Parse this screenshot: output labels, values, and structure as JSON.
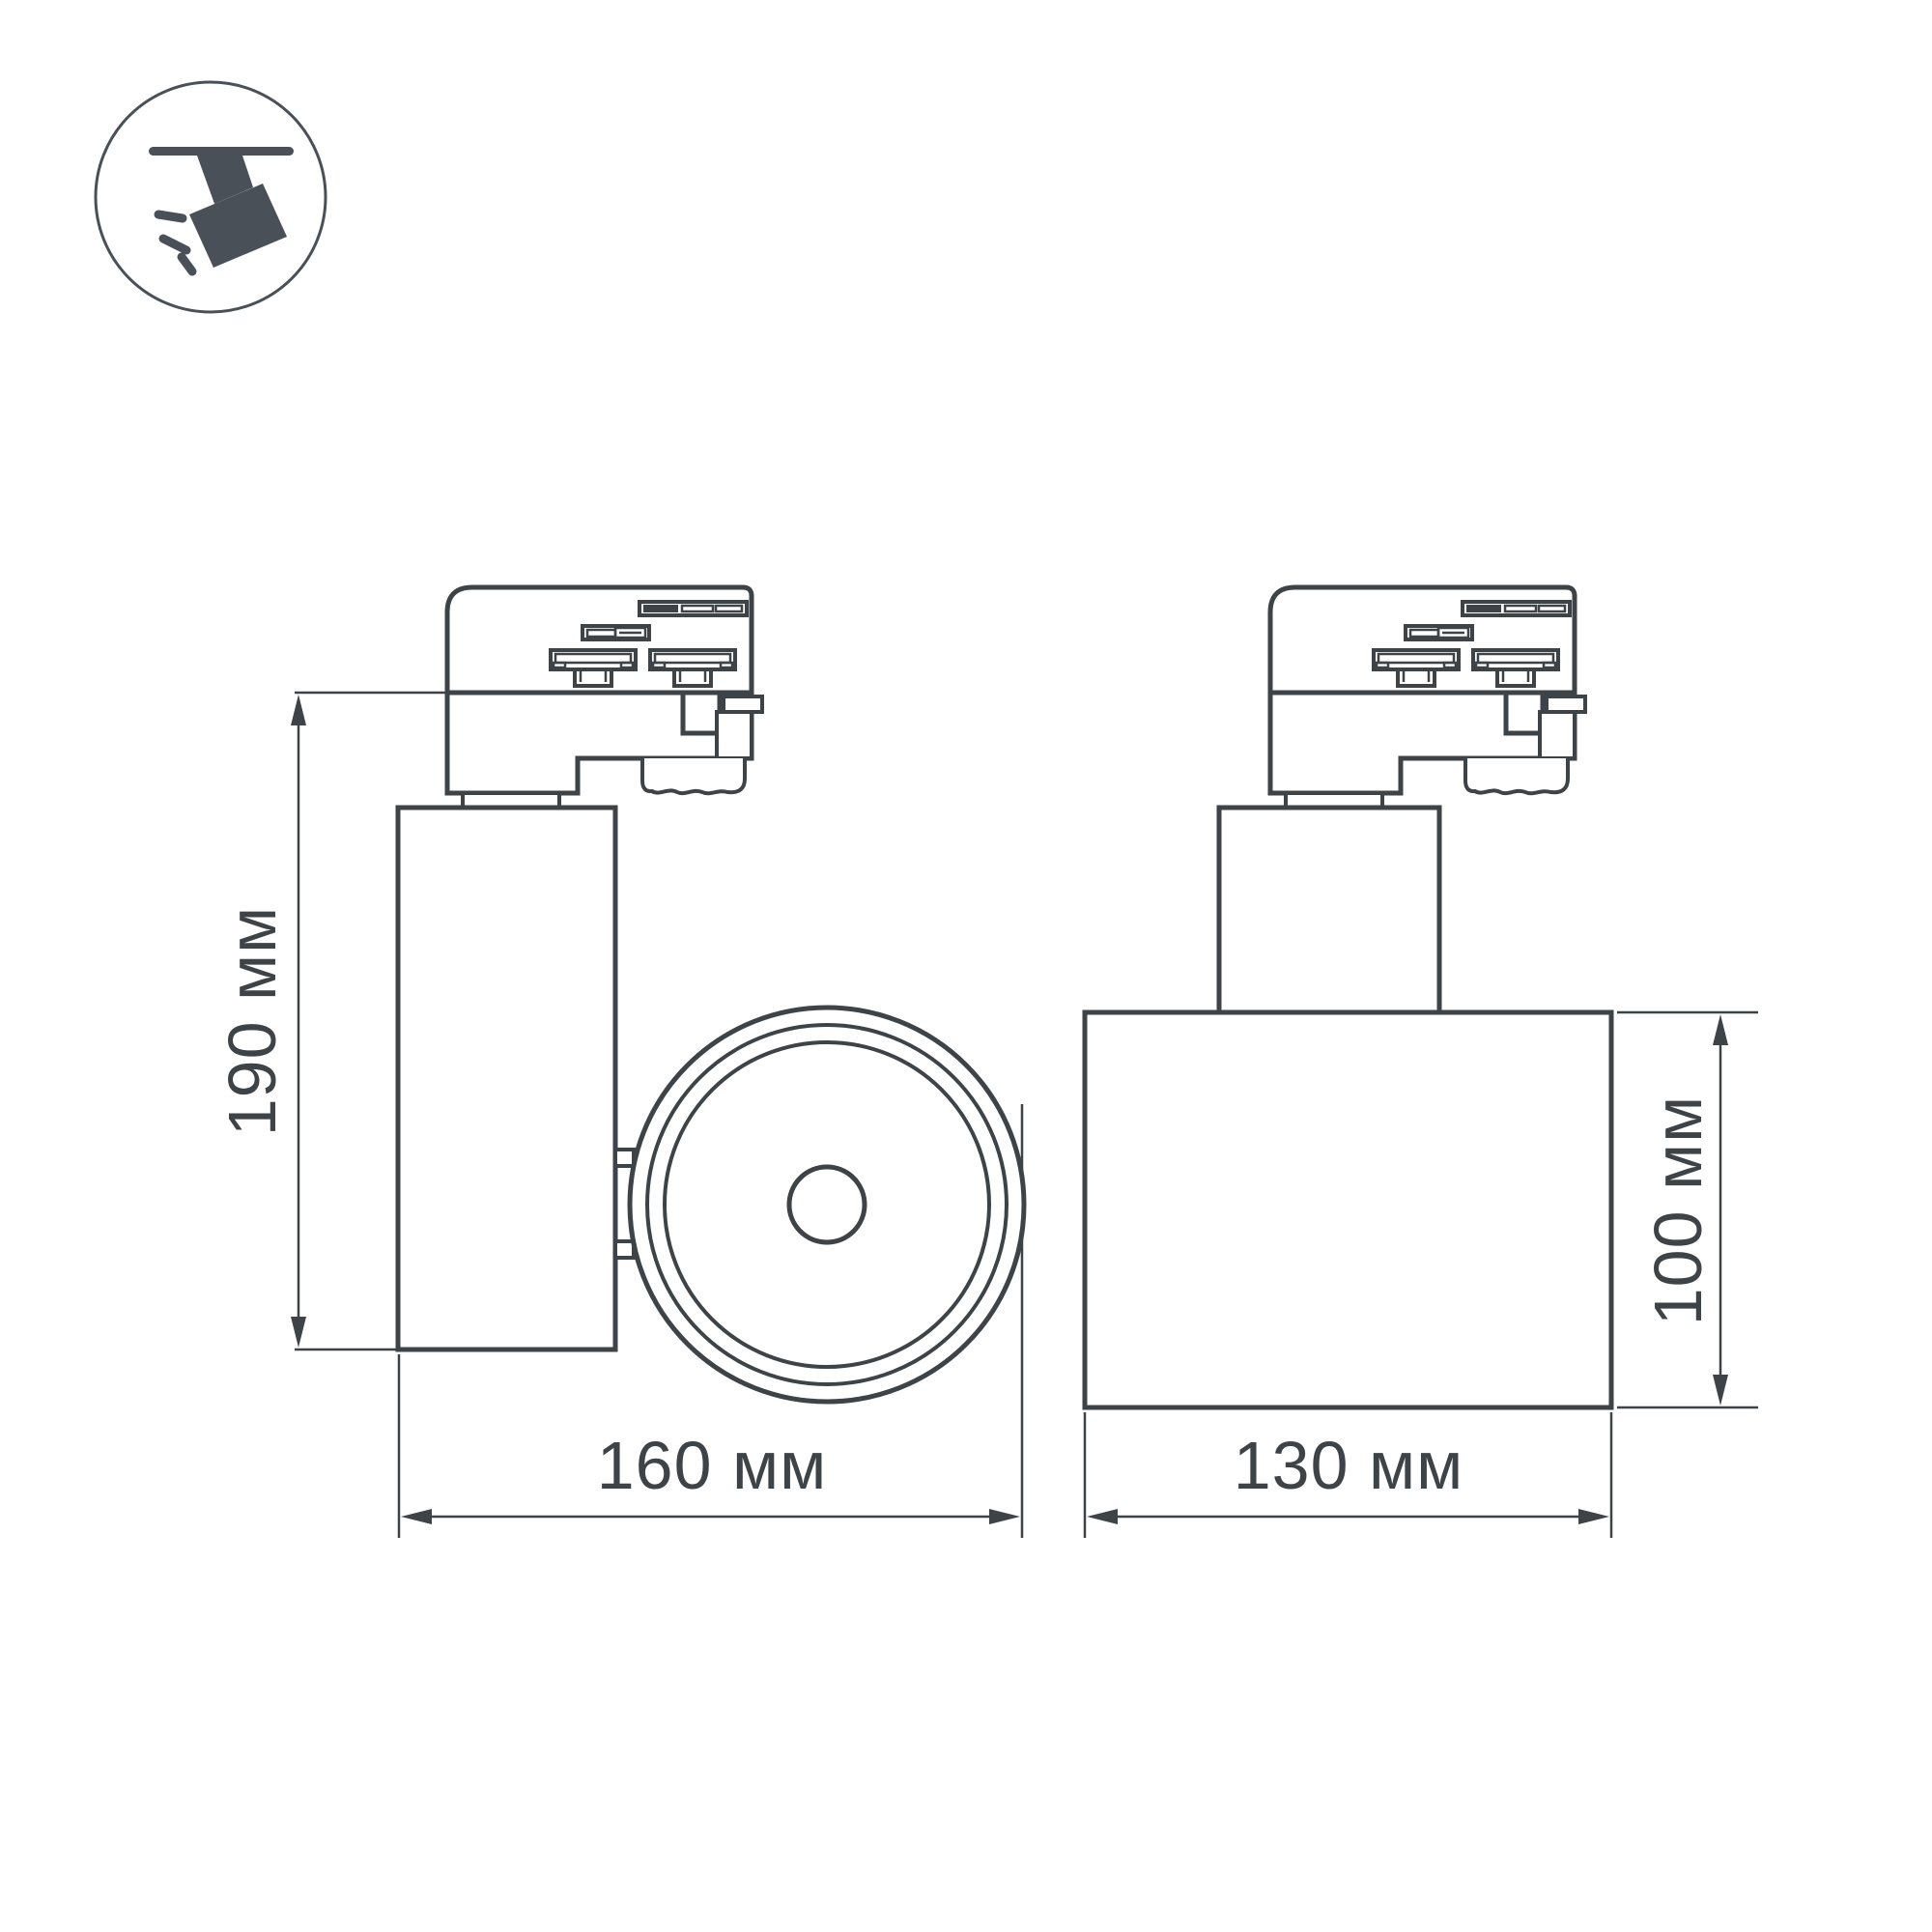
{
  "colors": {
    "ink": "#3e4347",
    "icon": "#4a5057",
    "background": "#ffffff"
  },
  "icon": {
    "name": "ceiling-track-spotlight",
    "description": "spotlight hanging from track, tilted, emitting light rays"
  },
  "side_view": {
    "height_label": "190 мм",
    "width_label": "160 мм"
  },
  "front_view": {
    "width_label": "130 мм",
    "height_label": "100 мм"
  }
}
